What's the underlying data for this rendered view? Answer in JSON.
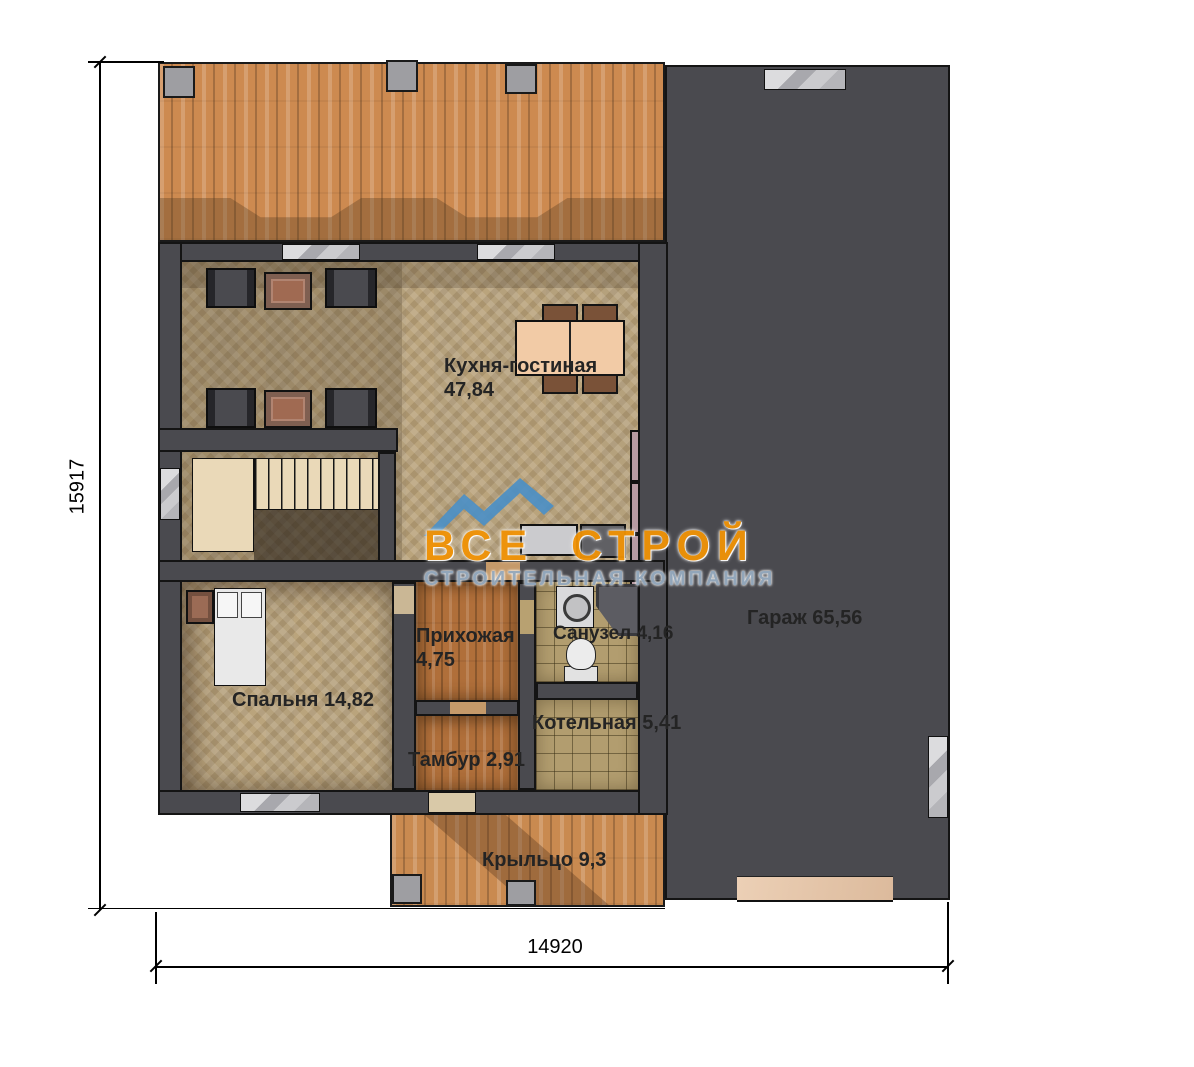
{
  "rooms": [
    {
      "id": "kitchen-living",
      "name": "Кухня-гостиная",
      "area": "47,84"
    },
    {
      "id": "garage",
      "name": "Гараж",
      "area": "65,56"
    },
    {
      "id": "bedroom",
      "name": "Спальня",
      "area": "14,82"
    },
    {
      "id": "hallway",
      "name": "Прихожая",
      "area": "4,75"
    },
    {
      "id": "bathroom",
      "name": "Санузел",
      "area": "4,16"
    },
    {
      "id": "boiler",
      "name": "Котельная",
      "area": "5,41"
    },
    {
      "id": "vestibule",
      "name": "Тамбур",
      "area": "2,91"
    },
    {
      "id": "porch",
      "name": "Крыльцо",
      "area": "9,3"
    }
  ],
  "dimensions": {
    "height_mm": "15917",
    "width_mm": "14920"
  },
  "watermark": {
    "line1": "ВСЕ СТРОЙ",
    "line2": "СТРОИТЕЛЬНАЯ КОМПАНИЯ"
  },
  "colors": {
    "wall": "#4a4a4f",
    "deck_wood": "#cd8a50",
    "interior_wood": "#c3ad85",
    "hall_wood": "#b06f3a",
    "tile": "#b29d6f",
    "garage_floor": "#e5c5a8",
    "watermark_orange": "#f19306",
    "watermark_blue": "#4a8fc7",
    "watermark_grey": "#96abc0"
  }
}
